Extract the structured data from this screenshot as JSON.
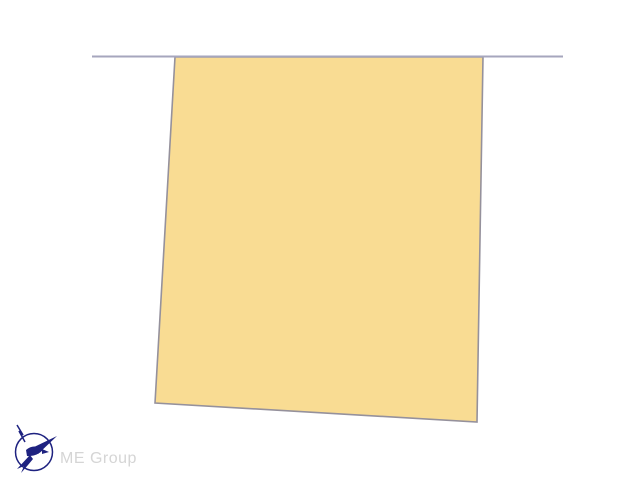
{
  "page": {
    "background": "#ffffff"
  },
  "diagram": {
    "parcel": {
      "points": "175,57 483,57 477,422 155,403",
      "fill": "#f9dc93",
      "stroke": "#95919c"
    },
    "boundary_line": {
      "x1": "92",
      "y1": "56.5",
      "x2": "563",
      "y2": "56.5",
      "color": "#a6a6bd"
    }
  },
  "logo": {
    "text": "ME Group",
    "text_color": "#d5d5d5",
    "mark_color": "#1e2280"
  }
}
